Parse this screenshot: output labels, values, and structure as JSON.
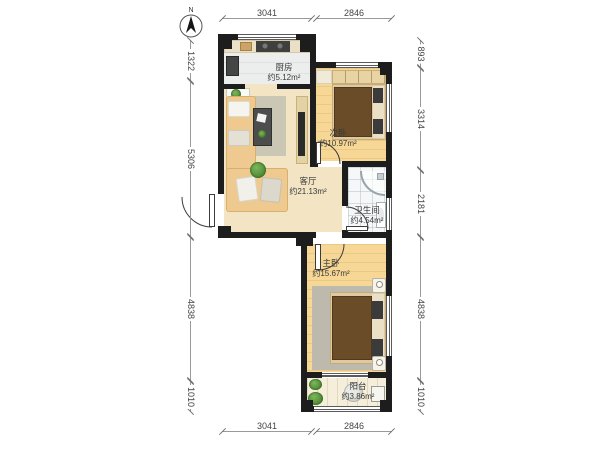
{
  "compass": {
    "north_label": "N"
  },
  "rooms": {
    "kitchen": {
      "name": "厨房",
      "area": "约5.12m²"
    },
    "bedroom2": {
      "name": "次卧",
      "area": "约10.97m²"
    },
    "living": {
      "name": "客厅",
      "area": "约21.13m²"
    },
    "bathroom": {
      "name": "卫生间",
      "area": "约4.54m²"
    },
    "master": {
      "name": "主卧",
      "area": "约15.67m²"
    },
    "balcony": {
      "name": "阳台",
      "area": "约3.86m²"
    }
  },
  "dimensions": {
    "top": [
      "3041",
      "2846"
    ],
    "bottom": [
      "3041",
      "2846"
    ],
    "left": [
      "1322",
      "5306",
      "4838",
      "1010"
    ],
    "right": [
      "893",
      "3314",
      "2181",
      "4838",
      "1010"
    ]
  },
  "colors": {
    "wall": "#1d1d1d",
    "wood_floor": "#f6d795",
    "living_floor": "#f3e4c4",
    "bed_blanket": "#6a4c28",
    "dimension_text": "#444444"
  }
}
